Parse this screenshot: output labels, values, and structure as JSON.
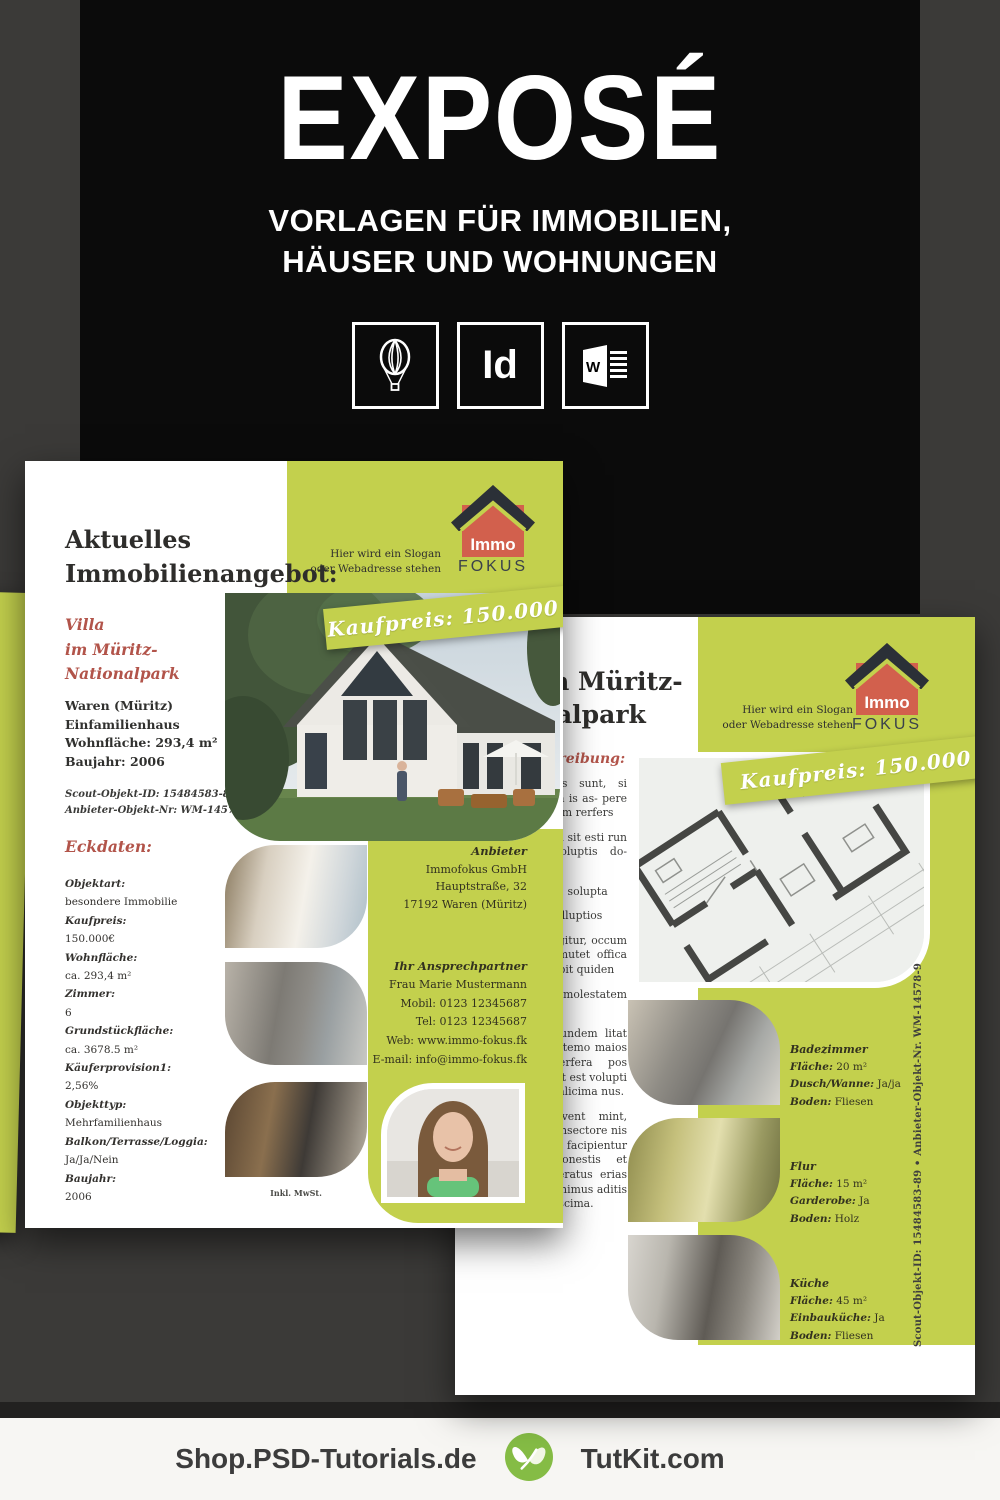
{
  "header": {
    "title": "EXPOSÉ",
    "subtitle_line1": "VORLAGEN FÜR IMMOBILIEN,",
    "subtitle_line2": "HÄUSER UND WOHNUNGEN",
    "apps": [
      "CorelDraw",
      "InDesign",
      "Word"
    ],
    "indesign_label": "Id"
  },
  "brand": {
    "logo_top": "Immo",
    "logo_bottom": "FOKUS",
    "slogan_line1": "Hier wird ein Slogan",
    "slogan_line2": "oder Webadresse stehen"
  },
  "flyer1": {
    "heading": "Aktuelles Immobilienangebot:",
    "ribbon": "Kaufpreis: 150.000 €",
    "title_lines": [
      "Villa",
      "im Müritz-",
      "Nationalpark"
    ],
    "facts": [
      "Waren (Müritz)",
      "Einfamilienhaus",
      "Wohnfläche: 293,4 m²",
      "Baujahr: 2006"
    ],
    "ids": [
      "Scout-Objekt-ID: 15484583-89",
      "Anbieter-Objekt-Nr: WM-14578-9"
    ],
    "eckdaten_heading": "Eckdaten:",
    "eckdaten": [
      {
        "label": "Objektart:",
        "value": "besondere Immobilie"
      },
      {
        "label": "Kaufpreis:",
        "value": "150.000€"
      },
      {
        "label": "Wohnfläche:",
        "value": "ca. 293,4 m²"
      },
      {
        "label": "Zimmer:",
        "value": "6"
      },
      {
        "label": "Grundstückfläche:",
        "value": "ca. 3678.5 m²"
      },
      {
        "label": "Käuferprovision1:",
        "value": "2,56%"
      },
      {
        "label": "Objekttyp:",
        "value": "Mehrfamilienhaus"
      },
      {
        "label": "Balkon/Terrasse/Loggia:",
        "value": "Ja/Ja/Nein"
      },
      {
        "label": "Baujahr:",
        "value": "2006"
      }
    ],
    "anbieter_heading": "Anbieter",
    "anbieter_lines": [
      "Immofokus GmbH",
      "Hauptstraße, 32",
      "17192 Waren (Müritz)"
    ],
    "contact_heading": "Ihr Ansprechpartner",
    "contact_lines": [
      "Frau Marie Mustermann",
      "Mobil: 0123 12345687",
      "Tel: 0123 12345687",
      "Web: www.immo-fokus.fk",
      "E-mail: info@immo-fokus.fk"
    ],
    "vat_note": "Inkl. MwSt."
  },
  "flyer2": {
    "title_lines": [
      "Villa im Müritz-",
      "Nationalpark"
    ],
    "desc_heading": "Objektbeschreibung:",
    "ribbon": "Kaufpreis: 150.000 €",
    "paragraphs": [
      "Ut voluptatus as sunt, si derfere, net volum is as- pere voluptas es- sendam rerfers",
      "Odit, nia con poria sit esti run tempore, nos voluptis do- loratiis is di di-",
      "Asero volores rem, solupta",
      "Adsectiis imen inulluptios",
      "Illudae as cum fugitur, occum etum. Luscius iumutet offica cullaborit. Emodebit quiden",
      "Dolupta tistre molestatem exerum.",
      "Aut de sequas dundem litat officia ubusto qui temo maios eossinvent optaerfera pos simaion sequaes ut est volupti onsedis dolor res alicima nus.",
      "Quidebit lab invent mint, corum fuga. It, nonsectore nis endignam, eum facipientur ma dundiste conestis et volesti nullece peratus erias quodis eiaspi digenimus aditis nobit eiusdan daescima."
    ],
    "rooms": [
      {
        "name": "Badezimmer",
        "l1": "Fläche:",
        "v1": "20 m²",
        "l2": "Dusch/Wanne:",
        "v2": "Ja/ja",
        "l3": "Boden:",
        "v3": "Fliesen"
      },
      {
        "name": "Flur",
        "l1": "Fläche:",
        "v1": "15 m²",
        "l2": "Garderobe:",
        "v2": "Ja",
        "l3": "Boden:",
        "v3": "Holz"
      },
      {
        "name": "Küche",
        "l1": "Fläche:",
        "v1": "45 m²",
        "l2": "Einbauküche:",
        "v2": "Ja",
        "l3": "Boden:",
        "v3": "Fliesen"
      }
    ],
    "side_text": "Scout-Objekt-ID: 15484583-89   •   Anbieter-Objekt-Nr. WM-14578-9"
  },
  "footer": {
    "left": "Shop.PSD-Tutorials.de",
    "right": "TutKit.com"
  },
  "colors": {
    "green": "#c3d04d",
    "red": "#b2544a",
    "logo_red": "#d2604d",
    "roof_dark": "#2b3037",
    "black": "#0b0b0b",
    "background": "#3b3a38",
    "footer_bg": "#f7f6f3",
    "tutkit_green": "#85bc45"
  }
}
